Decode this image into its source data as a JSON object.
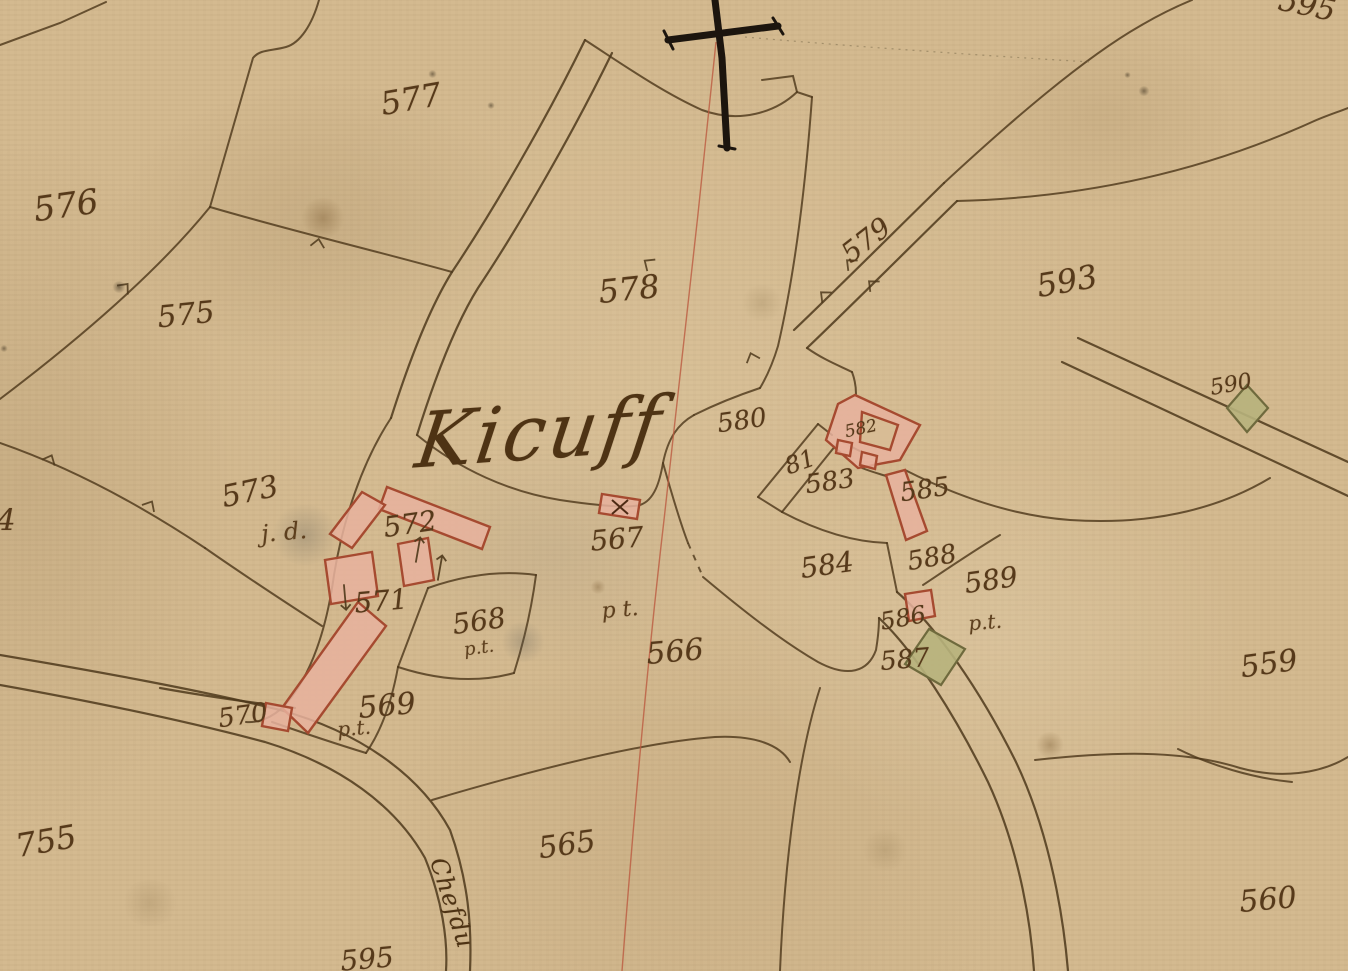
{
  "map": {
    "kind": "historical-cadastral-map",
    "place_name": "Kicuff",
    "road_label": "Chefdu",
    "colors": {
      "paper": "#d4ba90",
      "boundary_ink": "#4e381b",
      "text_ink": "#56391a",
      "building_fill": "#e7b19d",
      "building_stroke": "#a64a30",
      "green_building_fill": "#b7b27c",
      "green_building_stroke": "#6f6a3d",
      "section_red_line": "#bb5a40",
      "cross_ink": "#1c150e"
    },
    "labels": [
      {
        "text": "595",
        "x": 1307,
        "y": 6,
        "rot": 12,
        "size": 30,
        "kind": "parcel"
      },
      {
        "text": "576",
        "x": 66,
        "y": 206,
        "rot": -8,
        "size": 34,
        "kind": "parcel"
      },
      {
        "text": "577",
        "x": 411,
        "y": 99,
        "rot": -10,
        "size": 32,
        "kind": "parcel"
      },
      {
        "text": "575",
        "x": 186,
        "y": 315,
        "rot": -6,
        "size": 30,
        "kind": "parcel"
      },
      {
        "text": "578",
        "x": 629,
        "y": 289,
        "rot": -6,
        "size": 32,
        "kind": "parcel"
      },
      {
        "text": "579",
        "x": 866,
        "y": 240,
        "rot": -38,
        "size": 28,
        "kind": "parcel"
      },
      {
        "text": "593",
        "x": 1067,
        "y": 281,
        "rot": -10,
        "size": 32,
        "kind": "parcel"
      },
      {
        "text": "573",
        "x": 250,
        "y": 492,
        "rot": -12,
        "size": 30,
        "kind": "parcel"
      },
      {
        "text": "572",
        "x": 410,
        "y": 524,
        "rot": -8,
        "size": 28,
        "kind": "parcel"
      },
      {
        "text": "571",
        "x": 381,
        "y": 601,
        "rot": -5,
        "size": 28,
        "kind": "parcel"
      },
      {
        "text": "568",
        "x": 479,
        "y": 621,
        "rot": -8,
        "size": 28,
        "kind": "parcel"
      },
      {
        "text": "569",
        "x": 387,
        "y": 706,
        "rot": -5,
        "size": 30,
        "kind": "parcel"
      },
      {
        "text": "570",
        "x": 243,
        "y": 716,
        "rot": -8,
        "size": 26,
        "kind": "parcel"
      },
      {
        "text": "567",
        "x": 617,
        "y": 539,
        "rot": -5,
        "size": 28,
        "kind": "parcel"
      },
      {
        "text": "566",
        "x": 675,
        "y": 652,
        "rot": -5,
        "size": 30,
        "kind": "parcel"
      },
      {
        "text": "565",
        "x": 567,
        "y": 845,
        "rot": -8,
        "size": 30,
        "kind": "parcel"
      },
      {
        "text": "580",
        "x": 742,
        "y": 421,
        "rot": -8,
        "size": 26,
        "kind": "parcel"
      },
      {
        "text": "81",
        "x": 800,
        "y": 462,
        "rot": -20,
        "size": 24,
        "kind": "parcel"
      },
      {
        "text": "582",
        "x": 861,
        "y": 429,
        "rot": -12,
        "size": 17,
        "kind": "parcel"
      },
      {
        "text": "583",
        "x": 830,
        "y": 482,
        "rot": -8,
        "size": 26,
        "kind": "parcel"
      },
      {
        "text": "584",
        "x": 827,
        "y": 565,
        "rot": -8,
        "size": 28,
        "kind": "parcel"
      },
      {
        "text": "585",
        "x": 925,
        "y": 490,
        "rot": -8,
        "size": 26,
        "kind": "parcel"
      },
      {
        "text": "586",
        "x": 903,
        "y": 618,
        "rot": -10,
        "size": 24,
        "kind": "parcel"
      },
      {
        "text": "587",
        "x": 905,
        "y": 660,
        "rot": -5,
        "size": 26,
        "kind": "parcel"
      },
      {
        "text": "588",
        "x": 932,
        "y": 558,
        "rot": -10,
        "size": 26,
        "kind": "parcel"
      },
      {
        "text": "589",
        "x": 991,
        "y": 580,
        "rot": -8,
        "size": 28,
        "kind": "parcel"
      },
      {
        "text": "590",
        "x": 1231,
        "y": 385,
        "rot": -10,
        "size": 22,
        "kind": "parcel"
      },
      {
        "text": "559",
        "x": 1269,
        "y": 664,
        "rot": -8,
        "size": 30,
        "kind": "parcel"
      },
      {
        "text": "560",
        "x": 1268,
        "y": 900,
        "rot": -5,
        "size": 30,
        "kind": "parcel"
      },
      {
        "text": "755",
        "x": 46,
        "y": 841,
        "rot": -10,
        "size": 32,
        "kind": "parcel"
      },
      {
        "text": "595",
        "x": 367,
        "y": 959,
        "rot": -5,
        "size": 28,
        "kind": "parcel"
      },
      {
        "text": "4",
        "x": 6,
        "y": 521,
        "rot": 0,
        "size": 30,
        "kind": "parcel"
      },
      {
        "text": "j. d.",
        "x": 284,
        "y": 532,
        "rot": -5,
        "size": 24,
        "kind": "annotation"
      },
      {
        "text": "p.t.",
        "x": 479,
        "y": 648,
        "rot": -8,
        "size": 18,
        "kind": "annotation"
      },
      {
        "text": "p.t.",
        "x": 354,
        "y": 728,
        "rot": -5,
        "size": 20,
        "kind": "annotation"
      },
      {
        "text": "p t.",
        "x": 620,
        "y": 610,
        "rot": -5,
        "size": 22,
        "kind": "annotation"
      },
      {
        "text": "p.t.",
        "x": 985,
        "y": 622,
        "rot": -5,
        "size": 20,
        "kind": "annotation"
      },
      {
        "text": "Kicuff",
        "x": 540,
        "y": 432,
        "rot": -4,
        "size": 76,
        "kind": "place"
      },
      {
        "text": "Chefdu",
        "x": 452,
        "y": 903,
        "rot": 72,
        "size": 24,
        "kind": "road"
      }
    ]
  }
}
